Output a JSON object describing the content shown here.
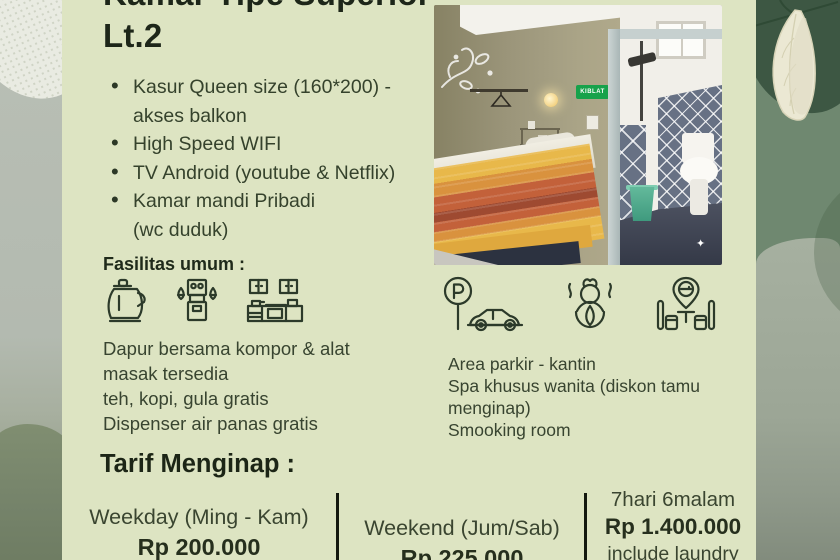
{
  "title": {
    "line1": "Kamar Tipe Superior",
    "line2": "Lt.2"
  },
  "features": [
    {
      "lines": [
        "Kasur Queen size (160*200) -",
        "akses balkon"
      ]
    },
    {
      "lines": [
        "High Speed WIFI"
      ]
    },
    {
      "lines": [
        "TV Android (youtube & Netflix)"
      ]
    },
    {
      "lines": [
        "Kamar mandi Pribadi",
        "(wc duduk)"
      ]
    }
  ],
  "fasilitas": {
    "heading": "Fasilitas umum :",
    "icons": [
      {
        "name": "kettle-icon"
      },
      {
        "name": "water-dispenser-icon"
      },
      {
        "name": "kitchen-set-icon"
      }
    ],
    "lines": [
      "Dapur bersama kompor & alat",
      "masak tersedia",
      "teh, kopi, gula gratis",
      "Dispenser air panas gratis"
    ]
  },
  "amenities": {
    "icons": [
      {
        "name": "parking-icon"
      },
      {
        "name": "spa-icon"
      },
      {
        "name": "smoking-room-icon"
      }
    ],
    "lines": [
      "Area parkir - kantin",
      "Spa khusus wanita (diskon tamu",
      "menginap)",
      "Smooking room"
    ]
  },
  "tarif": {
    "heading": "Tarif Menginap :",
    "columns": [
      {
        "label": "Weekday (Ming - Kam)",
        "price": "Rp 200.000"
      },
      {
        "label": "Weekend (Jum/Sab)",
        "price": "Rp 225.000"
      },
      {
        "label": "7hari 6malam",
        "price": "Rp 1.400.000",
        "note": "include laundry"
      }
    ]
  },
  "photo": {
    "sign_text": "KIBLAT"
  },
  "colors": {
    "panel_bg": "#dde4c2",
    "dark_green_blob": "#3d5743",
    "mid_green": "#6f8870",
    "sage": "#a3ae9d",
    "left_strip_gray": "#b4bbb1",
    "olive_wave": "#75836a",
    "title_text": "#1d2619",
    "body_text": "#384430",
    "divider_black": "#14190f",
    "sign_green": "#17a24b",
    "duvet_yellow": "#e8b84a",
    "duvet_red": "#c3613a"
  }
}
